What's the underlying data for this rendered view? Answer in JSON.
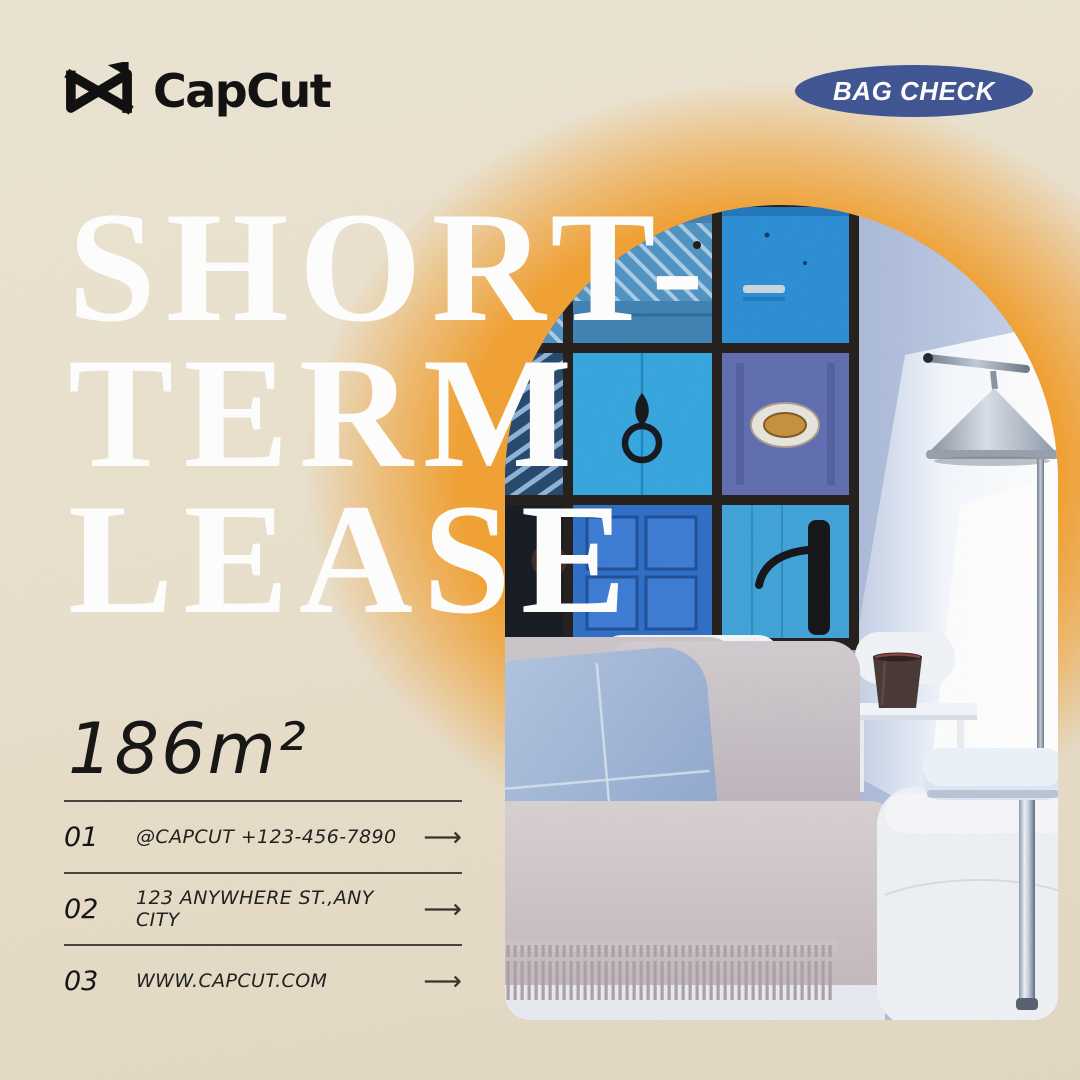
{
  "poster": {
    "brand": {
      "name": "CapCut"
    },
    "badge": {
      "label": "BAG CHECK"
    },
    "headline": {
      "lines": [
        "SHORT-",
        "TERM",
        "LEASE"
      ]
    },
    "area_label": "186m²",
    "contacts": [
      {
        "num": "01",
        "text": "@CAPCUT  +123-456-7890",
        "arrow": "⟶"
      },
      {
        "num": "02",
        "text": "123 ANYWHERE ST.,ANY CITY",
        "arrow": "⟶"
      },
      {
        "num": "03",
        "text": "WWW.CAPCUT.COM",
        "arrow": "⟶"
      }
    ],
    "colors": {
      "background_beige": "#E9E0CD",
      "badge_blue": "#3E5493",
      "glow_orange": "#F2A133",
      "headline_white": "#FFFFFF",
      "text_dark": "#1C1C1C",
      "divider": "#46413A"
    }
  }
}
